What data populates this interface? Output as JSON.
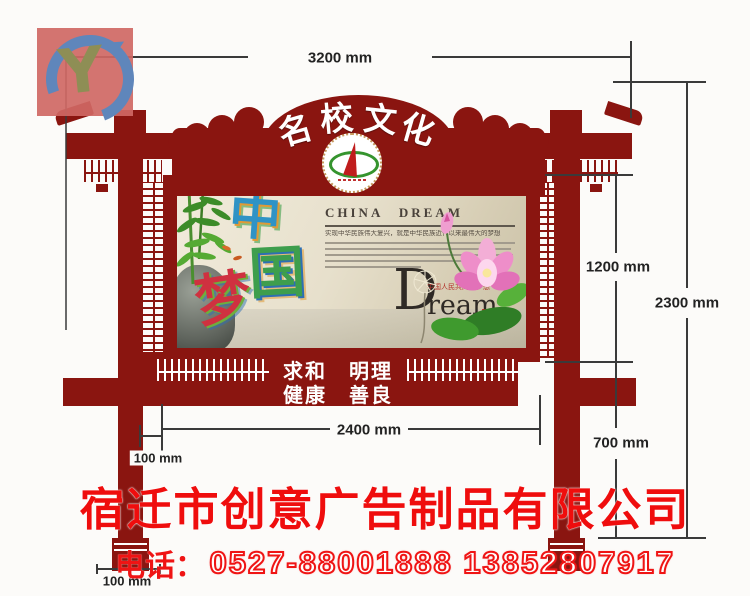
{
  "watermark": {
    "letter": "Y"
  },
  "dimensions": {
    "total_width": "3200 mm",
    "total_height": "2300 mm",
    "board_height": "1200 mm",
    "leg_height": "700 mm",
    "board_width": "2400 mm",
    "post_offset": "100 mm",
    "leg_width": "100 mm"
  },
  "header": {
    "chars": [
      "名",
      "校",
      "文",
      "化"
    ]
  },
  "poster": {
    "calligraphy": [
      "中",
      "国",
      "梦"
    ],
    "heading": "CHINA DREAM",
    "subline": "实现中华民族伟大复兴，就是中华民族近代以来最伟大的梦想",
    "dream": {
      "initial": "D",
      "rest": "ream",
      "comma": ",",
      "note": "中国人民共同的梦想"
    }
  },
  "slogan": {
    "line1": "求和　明理",
    "line2": "健康　善良"
  },
  "footer": {
    "company": "宿迁市创意广告制品有限公司",
    "phone_label": "电话：",
    "phone": "0527-88001888 13852807917"
  },
  "colors": {
    "frame_red": "#8a1510",
    "bright_red": "#ef0d0d",
    "dim_line": "#3a3a3a"
  }
}
